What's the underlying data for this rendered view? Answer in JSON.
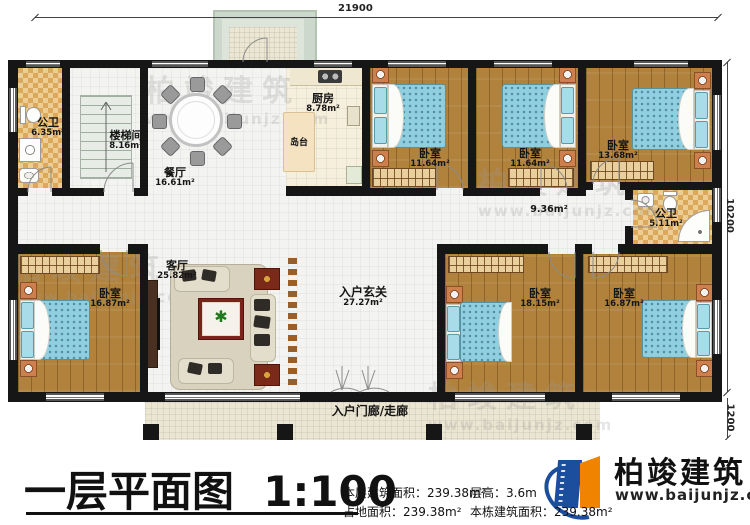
{
  "title": {
    "text": "一层平面图",
    "scale": "1:100"
  },
  "dimensions": {
    "top": "21900",
    "right": "10200",
    "right_lower": "1200"
  },
  "rooms": {
    "public_bath_1": {
      "name": "公卫",
      "area": "6.35m²"
    },
    "stairwell": {
      "name": "楼梯间",
      "area": "8.16m²"
    },
    "dining": {
      "name": "餐厅",
      "area": "16.61m²"
    },
    "kitchen": {
      "name": "厨房",
      "area": "8.78m²"
    },
    "island": {
      "name": "岛台"
    },
    "bedroom_top_1": {
      "name": "卧室",
      "area": "11.64m²"
    },
    "bedroom_top_2": {
      "name": "卧室",
      "area": "11.64m²"
    },
    "bedroom_top_3": {
      "name": "卧室",
      "area": "13.68m²"
    },
    "hallway": {
      "area": "9.36m²"
    },
    "public_bath_2": {
      "name": "公卫",
      "area": "5.11m²"
    },
    "bedroom_left": {
      "name": "卧室",
      "area": "16.87m²"
    },
    "living": {
      "name": "客厅",
      "area": "25.82m²"
    },
    "foyer": {
      "name": "入户玄关",
      "area": "27.27m²"
    },
    "bedroom_bottom_1": {
      "name": "卧室",
      "area": "18.15m²"
    },
    "bedroom_bottom_2": {
      "name": "卧室",
      "area": "16.87m²"
    },
    "porch": {
      "name": "入户门廊/走廊"
    }
  },
  "stats": {
    "floor_area_label": "本层建筑面积：",
    "floor_area": "239.38m²",
    "land_label": "占地面积：",
    "land_area": "239.38m²",
    "height_label": "层高：",
    "height": "3.6m",
    "total_label": "本栋建筑面积：",
    "total_area": "239.38m²"
  },
  "brand": {
    "name": "柏竣建筑",
    "site": "www.baijunjz.com"
  },
  "watermark": {
    "name": "柏竣建筑",
    "site": "www.baijunjz.com"
  },
  "colors": {
    "wall": "#161616",
    "wood_floor": "#b1823c",
    "bath_tile": "#dca95c",
    "bed_blue": "#8fcfe0",
    "brand_blue": "#1c4e9e",
    "brand_orange": "#f08300"
  }
}
